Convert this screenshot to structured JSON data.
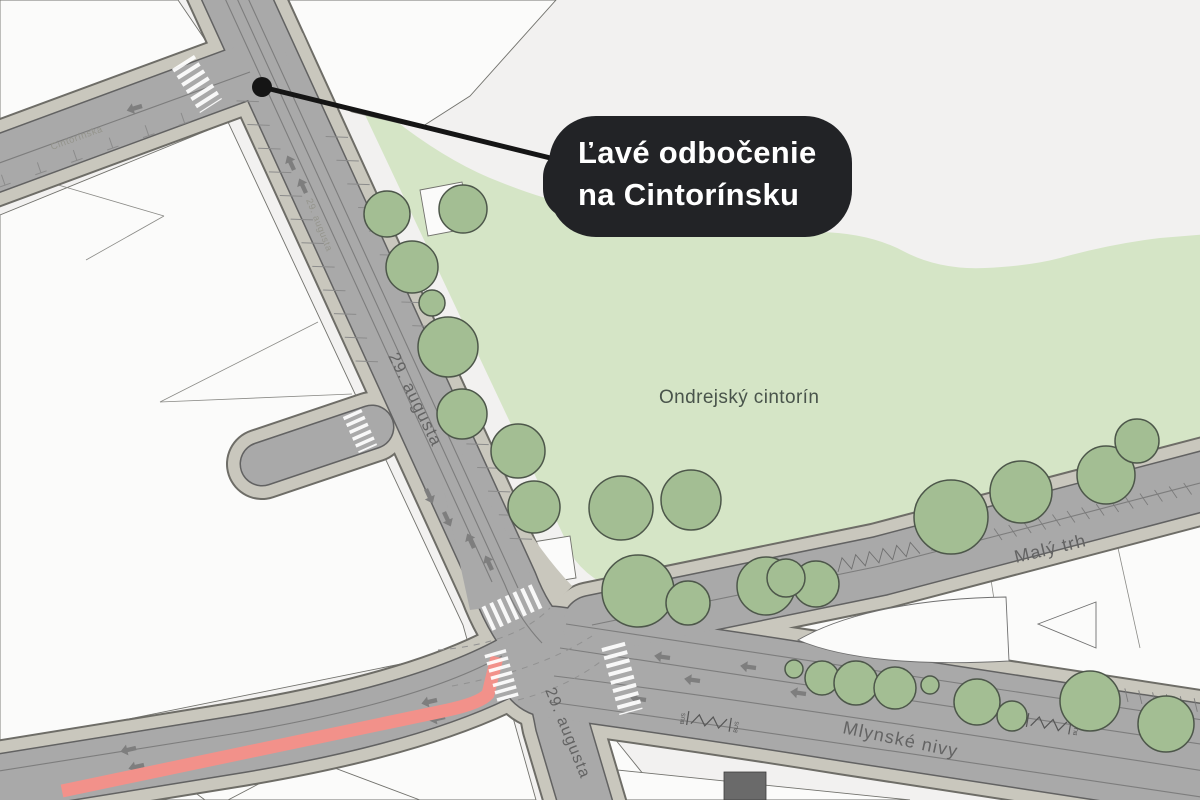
{
  "callout": {
    "line1": "Ľavé odbočenie",
    "line2": "na Cintorínsku"
  },
  "park": {
    "label": "Ondrejský cintorín"
  },
  "streets": {
    "augusta_main": "29. augusta",
    "augusta_south": "29. augusta",
    "augusta_small": "29. augusta",
    "cintorinska": "Cintorínska",
    "maly_trh": "Malý trh",
    "mlynske_nivy": "Mlynské nivy"
  },
  "road_markings": {
    "bus": "BUS"
  },
  "colors": {
    "background": "#f2f1f0",
    "park_green": "#d5e5c6",
    "tree_green": "#a3be93",
    "tree_outline": "#4d574a",
    "road_gray": "#a9a9a9",
    "sidewalk_taupe": "#c9c7bd",
    "building_white": "#fbfbfa",
    "highlight_red": "#f2918a",
    "callout_black": "#222326",
    "crosswalk_white": "#ffffff"
  }
}
